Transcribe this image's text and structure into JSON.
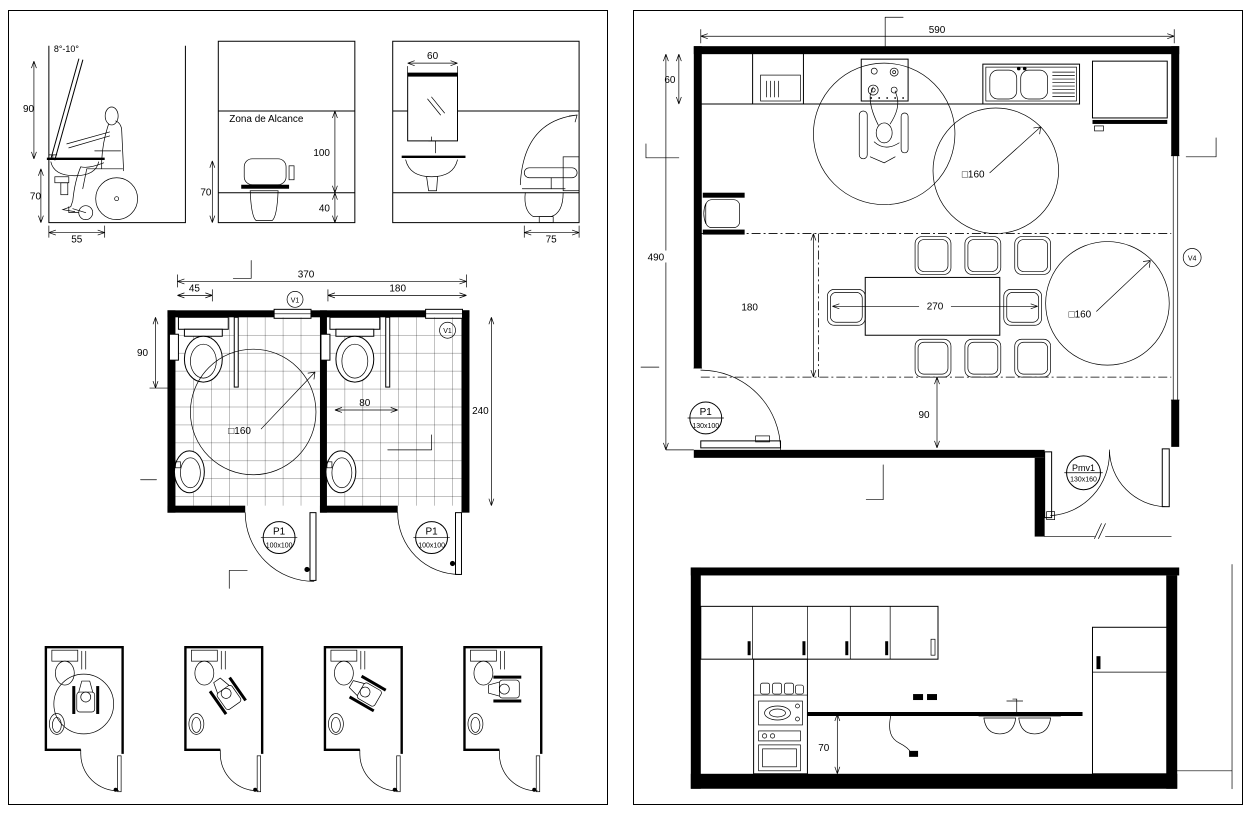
{
  "sheet_left": {
    "view_basin": {
      "mirror_angle": "8°-10°",
      "mirror_height": "90",
      "basin_height": "70",
      "basin_depth": "55"
    },
    "view_reach": {
      "title": "Zona de Alcance",
      "upper_reach": "100",
      "toilet_height": "70",
      "lower_reach": "40"
    },
    "view_mirror": {
      "mirror_width": "60"
    },
    "view_wc_side": {
      "wc_depth": "75"
    },
    "plan": {
      "overall_width": "370",
      "left_offset": "45",
      "right_width": "180",
      "wc_axis": "90",
      "room_depth": "240",
      "side_clearance": "80",
      "turning_circle": "□160",
      "window_tag": "V1",
      "door_tag": "P1",
      "door_size": "100x100"
    }
  },
  "sheet_right": {
    "plan": {
      "overall_width": "590",
      "counter_depth": "60",
      "overall_depth": "490",
      "dining_depth": "180",
      "table_length": "270",
      "aisle_width": "90",
      "turning_circle": "□160",
      "window_tag": "V4",
      "door_tag": "P1",
      "door_size": "130x100",
      "double_door_tag": "Pmv1",
      "double_door_size": "130x160"
    },
    "elevation": {
      "counter_height": "70"
    }
  }
}
